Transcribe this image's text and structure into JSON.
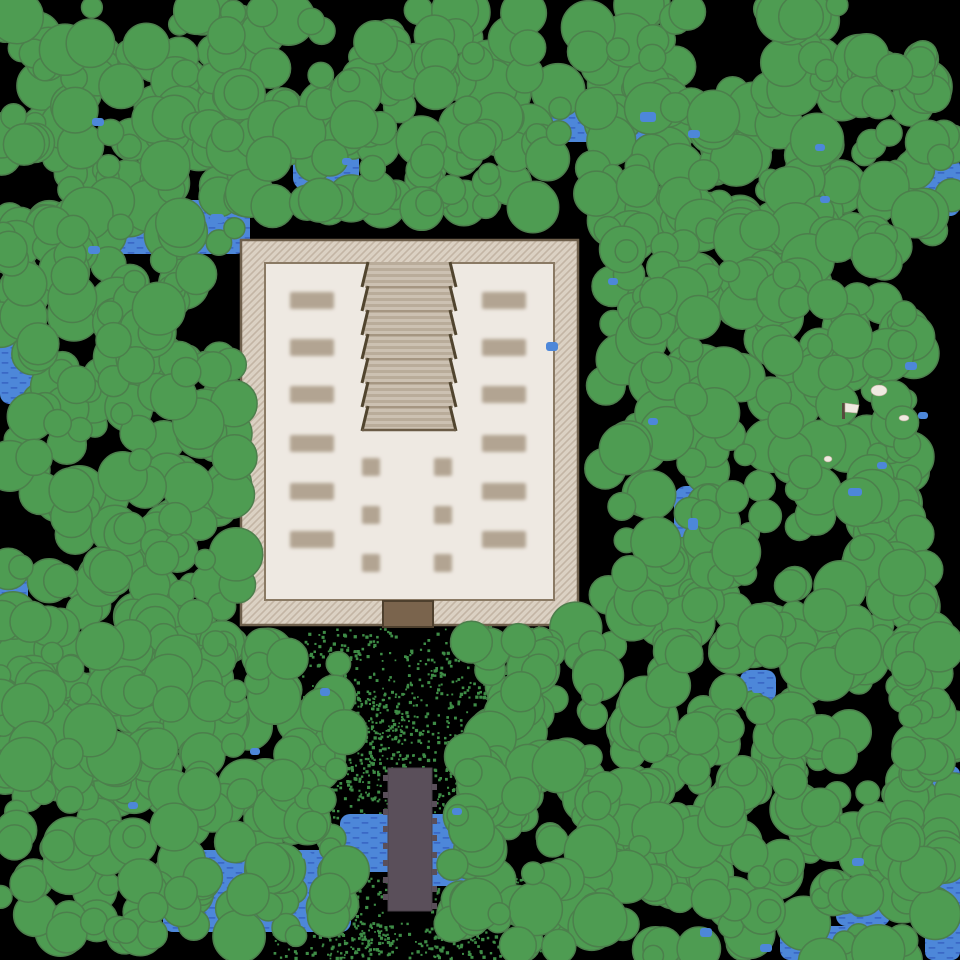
{
  "map": {
    "width": 960,
    "height": 960,
    "seed": 7,
    "background": "#000000"
  },
  "colors": {
    "background": "#000000",
    "tree_fill": "#4e9c52",
    "tree_outline": "#4c7f4c",
    "water_fill": "#4d87d9",
    "water_dash": "#3a68c6",
    "speckle": "#3e8c46",
    "wall_bg": "#dbd1c3",
    "wall_hatch": "#c3b5a4",
    "wall_border": "#6f604c",
    "floor_fill": "#eee9e2",
    "floor_border": "#8a7a64",
    "stair_light": "#ccc1b2",
    "stair_dark": "#b9ac9a",
    "stair_edge": "#51452f",
    "stair_sep": "#a2937e",
    "stair_bottom": "#6b5c47",
    "pillar": "#b2a492",
    "door_fill": "#7a644d",
    "door_border": "#4e402e",
    "bridge_fill": "#5a4f5a",
    "bridge_edge": "#4a414a",
    "marker_fill": "#f0eae1",
    "marker_pole": "#564a3c"
  },
  "forest": {
    "radius_min": 10,
    "radius_max": 27,
    "clusters": [
      [
        0,
        0,
        252,
        238,
        115
      ],
      [
        225,
        10,
        345,
        200,
        133
      ],
      [
        588,
        0,
        100,
        235,
        45
      ],
      [
        675,
        92,
        105,
        145,
        29
      ],
      [
        768,
        0,
        105,
        235,
        47
      ],
      [
        860,
        52,
        100,
        185,
        36
      ],
      [
        605,
        228,
        310,
        735,
        438
      ],
      [
        900,
        565,
        55,
        380,
        40
      ],
      [
        468,
        622,
        135,
        215,
        56
      ],
      [
        0,
        222,
        238,
        515,
        236
      ],
      [
        0,
        638,
        352,
        305,
        206
      ],
      [
        452,
        752,
        155,
        195,
        58
      ]
    ]
  },
  "water": {
    "patches": [
      [
        98,
        200,
        152,
        54,
        14
      ],
      [
        293,
        146,
        66,
        44,
        12
      ],
      [
        540,
        106,
        126,
        36,
        12
      ],
      [
        912,
        156,
        48,
        60,
        10
      ],
      [
        0,
        280,
        40,
        124,
        10
      ],
      [
        0,
        570,
        28,
        84,
        10
      ],
      [
        674,
        486,
        36,
        68,
        12
      ],
      [
        740,
        670,
        36,
        32,
        10
      ],
      [
        928,
        766,
        32,
        72,
        8
      ],
      [
        925,
        858,
        35,
        102,
        8
      ],
      [
        780,
        926,
        106,
        34,
        10
      ],
      [
        836,
        894,
        54,
        32,
        10
      ]
    ],
    "stream": [
      [
        340,
        814,
        152,
        58,
        10
      ],
      [
        420,
        836,
        66,
        50,
        10
      ],
      [
        163,
        850,
        188,
        82,
        10
      ],
      [
        246,
        872,
        82,
        34,
        8
      ]
    ],
    "puddles": [
      [
        640,
        112,
        16,
        10
      ],
      [
        688,
        130,
        12,
        8
      ],
      [
        546,
        342,
        12,
        9
      ],
      [
        820,
        196,
        10,
        7
      ],
      [
        905,
        362,
        12,
        8
      ],
      [
        688,
        518,
        10,
        12
      ],
      [
        752,
        684,
        12,
        9
      ],
      [
        848,
        488,
        14,
        8
      ],
      [
        320,
        688,
        10,
        8
      ],
      [
        250,
        748,
        10,
        7
      ],
      [
        452,
        808,
        10,
        7
      ],
      [
        700,
        928,
        12,
        9
      ],
      [
        760,
        944,
        12,
        8
      ],
      [
        852,
        858,
        12,
        8
      ],
      [
        918,
        412,
        10,
        7
      ],
      [
        88,
        246,
        12,
        8
      ],
      [
        128,
        802,
        10,
        7
      ],
      [
        302,
        852,
        10,
        7
      ],
      [
        608,
        278,
        10,
        7
      ],
      [
        648,
        418,
        10,
        7
      ],
      [
        92,
        118,
        12,
        8
      ],
      [
        210,
        214,
        14,
        9
      ],
      [
        342,
        158,
        10,
        7
      ],
      [
        815,
        144,
        10,
        7
      ],
      [
        877,
        462,
        10,
        7
      ]
    ]
  },
  "speckles": {
    "dot_size": 2.4,
    "regions": [
      [
        302,
        628,
        200,
        142,
        500
      ],
      [
        325,
        772,
        62,
        186,
        250
      ],
      [
        434,
        772,
        66,
        100,
        190
      ],
      [
        430,
        868,
        112,
        90,
        230
      ],
      [
        272,
        922,
        170,
        36,
        140
      ],
      [
        478,
        612,
        62,
        100,
        110
      ],
      [
        348,
        690,
        58,
        82,
        120
      ]
    ]
  },
  "temple": {
    "outer": [
      241,
      240,
      337,
      385
    ],
    "floor": [
      265,
      263,
      289,
      337
    ],
    "stairs": {
      "cx": 409,
      "top": 262,
      "flights": 7,
      "flight_h": 24,
      "half_top": 41,
      "half_bottom": 47
    },
    "pillars": {
      "w": 44,
      "h": 17,
      "left_x": 290,
      "right_x": 482,
      "ys": [
        292,
        339,
        386,
        435,
        483,
        531
      ]
    },
    "plinths": {
      "size": 18,
      "xs": [
        362,
        434
      ],
      "ys": [
        458,
        506,
        554
      ]
    },
    "door": [
      383,
      601,
      50,
      26
    ]
  },
  "bridge": {
    "x": 388,
    "y": 768,
    "w": 44,
    "h": 143,
    "notch_size": 6,
    "notch_step": 17
  },
  "markers": {
    "flags": [
      [
        842,
        403
      ]
    ],
    "dots": [
      [
        871,
        385,
        16,
        11
      ],
      [
        899,
        415,
        10,
        6
      ],
      [
        824,
        456,
        8,
        6
      ]
    ]
  }
}
